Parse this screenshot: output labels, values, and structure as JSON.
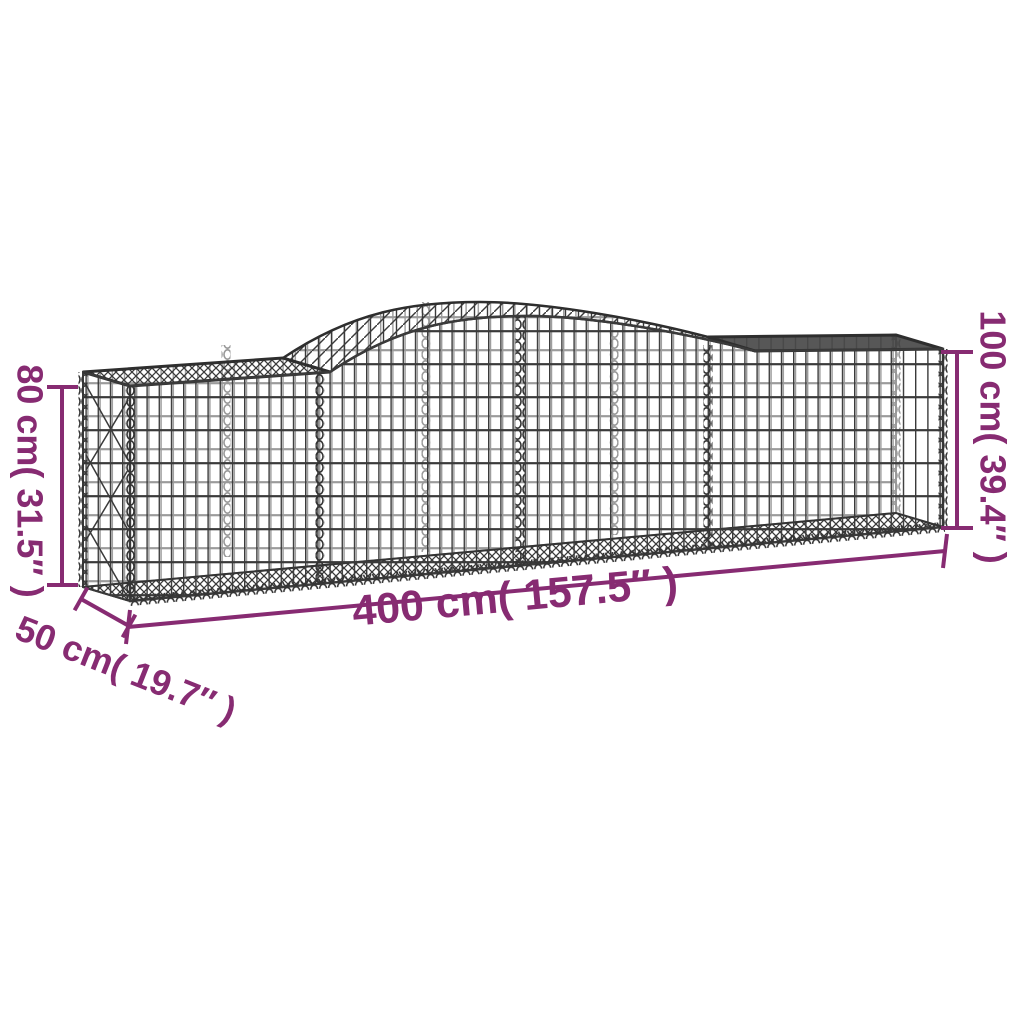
{
  "page": {
    "background": "#ffffff"
  },
  "illustration": {
    "subject": "arched gabion basket wire mesh drawing",
    "wire_color": "#3a3a3a"
  },
  "dimensions": {
    "accent_color": "#872B72",
    "height_left": "80 cm( 31.5″ )",
    "height_right": "100 cm( 39.4″ )",
    "length": "400 cm( 157.5″ )",
    "depth": "50 cm( 19.7″ )"
  }
}
